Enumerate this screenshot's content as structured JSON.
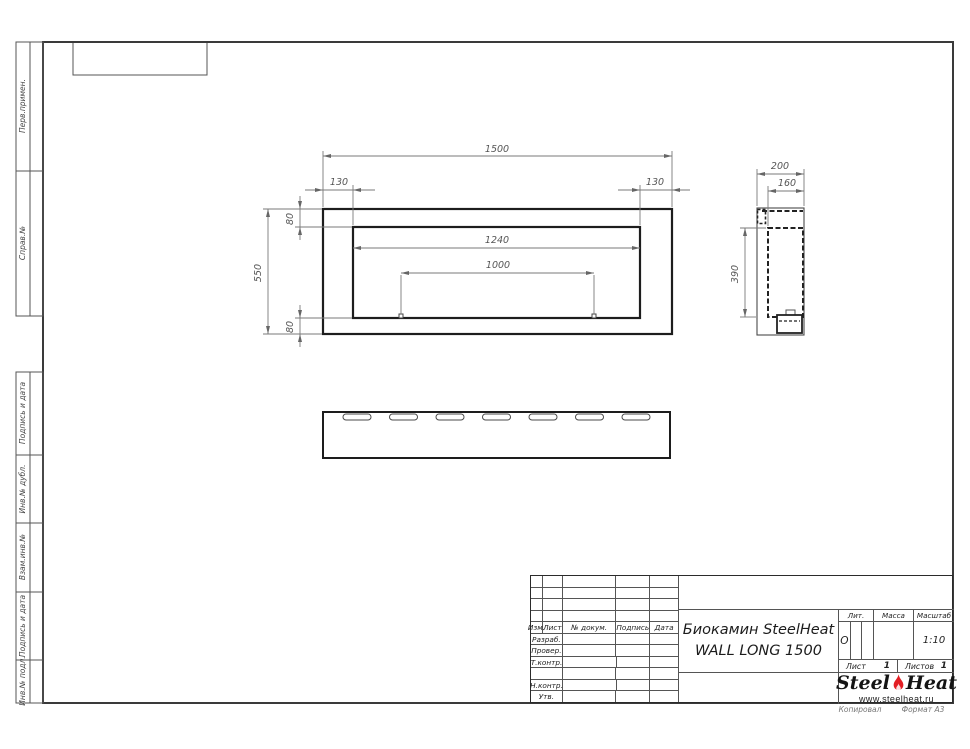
{
  "page": {
    "copied_label": "Копировал",
    "format_label": "Формат А3"
  },
  "margin_stamps": {
    "upper": [
      "Перв.примен.",
      "Справ.№"
    ],
    "lower": [
      "Подпись и дата",
      "Инв.№ дубл.",
      "Взам.инв.№",
      "Подпись и дата",
      "Инв.№ подл."
    ]
  },
  "title_block": {
    "header_columns": [
      "Изм.",
      "Лист",
      "№ докум.",
      "Подпись",
      "Дата"
    ],
    "row_labels": [
      "Разраб.",
      "Провер.",
      "Т.контр.",
      "",
      "Н.контр.",
      "Утв."
    ],
    "title_line1": "Биокамин SteelHeat",
    "title_line2": "WALL LONG 1500",
    "lit_label": "Лит.",
    "lit_value": "О",
    "mass_label": "Масса",
    "mass_value": "",
    "scale_label": "Масштаб",
    "scale_value": "1:10",
    "sheet_label": "Лист",
    "sheet_number": "1",
    "sheets_label": "Листов",
    "sheets_total": "1",
    "logo": {
      "word1": "Steel",
      "word2": "Heat",
      "website": "www.steelheat.ru",
      "flame_color": "#e31e24"
    }
  },
  "drawing": {
    "front_view": {
      "overall_width": "1500",
      "overall_height": "550",
      "left_offset": "130",
      "right_offset": "130",
      "top_offset": "80",
      "bottom_offset": "80",
      "opening_width": "1240",
      "burner_width": "1000"
    },
    "side_view": {
      "depth": "200",
      "inner_depth": "160",
      "inner_height": "390"
    },
    "bottom_view": {
      "slot_count": 7
    }
  }
}
